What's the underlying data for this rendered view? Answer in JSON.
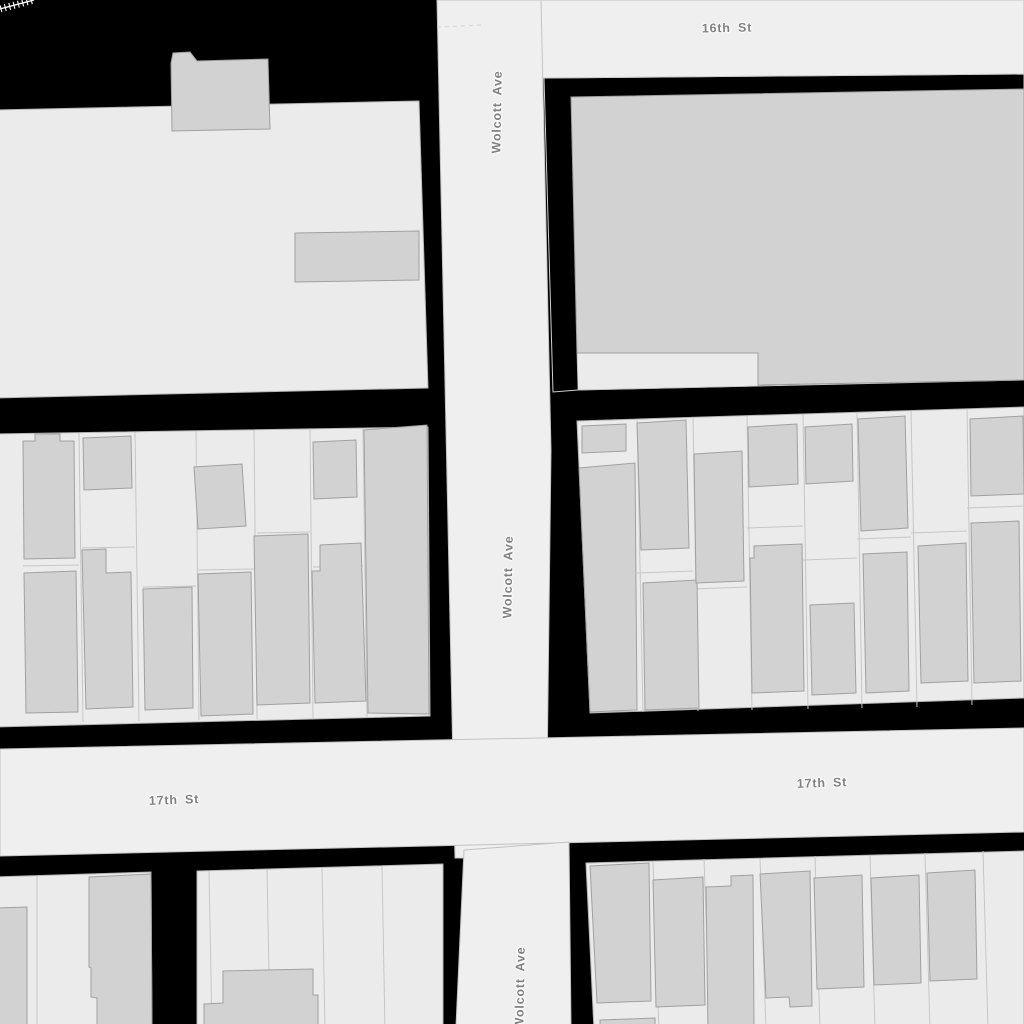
{
  "map": {
    "background": "#000000",
    "colors": {
      "street_fill": "#efefef",
      "block_fill": "#ebebeb",
      "building_fill": "#d2d2d2",
      "building_stroke": "#a0a0a0",
      "label_color": "#818181",
      "railroad": "#ffffff"
    },
    "labels": [
      {
        "text": "16th St",
        "x": 727,
        "y": 28,
        "rotate": -1
      },
      {
        "text": "Wolcott Ave",
        "x": 497,
        "y": 112,
        "rotate": -89
      },
      {
        "text": "Wolcott Ave",
        "x": 508,
        "y": 577,
        "rotate": -89
      },
      {
        "text": "17th St",
        "x": 174,
        "y": 800,
        "rotate": -2
      },
      {
        "text": "17th St",
        "x": 822,
        "y": 783,
        "rotate": -2
      },
      {
        "text": "Wolcott Ave",
        "x": 520,
        "y": 988,
        "rotate": -89
      }
    ],
    "streets": [
      {
        "name": "16th-st-band",
        "points": [
          [
            437,
            0
          ],
          [
            1024,
            0
          ],
          [
            1024,
            74
          ],
          [
            544,
            78
          ],
          [
            452,
            84
          ]
        ]
      },
      {
        "name": "wolcott-ave-upper",
        "points": [
          [
            437,
            0
          ],
          [
            541,
            0
          ],
          [
            551,
            450
          ],
          [
            546,
            858
          ],
          [
            455,
            858
          ],
          [
            446,
            430
          ]
        ]
      },
      {
        "name": "17th-st-band",
        "points": [
          [
            0,
            749
          ],
          [
            1024,
            728
          ],
          [
            1024,
            832
          ],
          [
            0,
            856
          ]
        ]
      },
      {
        "name": "wolcott-ave-lower",
        "points": [
          [
            464,
            850
          ],
          [
            569,
            842
          ],
          [
            571,
            1026
          ],
          [
            456,
            1026
          ]
        ]
      }
    ],
    "blocks": [
      {
        "name": "block-top-left",
        "style": "block",
        "points": [
          [
            -6,
            110
          ],
          [
            419,
            101
          ],
          [
            428,
            388
          ],
          [
            -6,
            398
          ]
        ]
      },
      {
        "name": "block-mid-left",
        "style": "block",
        "points": [
          [
            -6,
            434
          ],
          [
            428,
            427
          ],
          [
            430,
            716
          ],
          [
            -6,
            727
          ]
        ]
      },
      {
        "name": "block-top-right",
        "style": "block-outline",
        "points": [
          [
            544,
            78
          ],
          [
            1024,
            74
          ],
          [
            1024,
            380
          ],
          [
            578,
            390
          ],
          [
            553,
            392
          ]
        ]
      },
      {
        "name": "block-top-right-parcel-notch",
        "style": "block-notch",
        "points": [
          [
            577,
            352
          ],
          [
            758,
            351
          ],
          [
            758,
            386
          ],
          [
            578,
            390
          ]
        ]
      },
      {
        "name": "block-mid-right",
        "style": "block",
        "points": [
          [
            577,
            421
          ],
          [
            1024,
            407
          ],
          [
            1024,
            698
          ],
          [
            590,
            713
          ]
        ]
      },
      {
        "name": "block-bottom-left-a",
        "style": "block",
        "points": [
          [
            -6,
            877
          ],
          [
            151,
            872
          ],
          [
            152,
            1030
          ],
          [
            -6,
            1030
          ]
        ]
      },
      {
        "name": "block-bottom-left-b",
        "style": "block",
        "points": [
          [
            197,
            871
          ],
          [
            443,
            864
          ],
          [
            443,
            1030
          ],
          [
            197,
            1030
          ]
        ]
      },
      {
        "name": "block-bottom-right",
        "style": "block",
        "points": [
          [
            586,
            863
          ],
          [
            1024,
            851
          ],
          [
            1024,
            1030
          ],
          [
            594,
            1030
          ]
        ]
      }
    ],
    "parcel_lines": [
      [
        79,
        433,
        83,
        722
      ],
      [
        135,
        432,
        139,
        721
      ],
      [
        196,
        431,
        199,
        720
      ],
      [
        254,
        430,
        257,
        719
      ],
      [
        310,
        430,
        313,
        718
      ],
      [
        363,
        429,
        367,
        717
      ],
      [
        23,
        566,
        79,
        565
      ],
      [
        82,
        548,
        135,
        547
      ],
      [
        143,
        587,
        196,
        586
      ],
      [
        198,
        570,
        254,
        569
      ],
      [
        257,
        533,
        310,
        532
      ],
      [
        313,
        567,
        363,
        566
      ],
      [
        637,
        419,
        643,
        712
      ],
      [
        693,
        417,
        698,
        711
      ],
      [
        747,
        416,
        752,
        710
      ],
      [
        803,
        414,
        808,
        709
      ],
      [
        857,
        412,
        862,
        708
      ],
      [
        911,
        411,
        917,
        707
      ],
      [
        967,
        409,
        972,
        705
      ],
      [
        637,
        573,
        693,
        571
      ],
      [
        693,
        589,
        747,
        587
      ],
      [
        747,
        528,
        803,
        526
      ],
      [
        803,
        560,
        857,
        558
      ],
      [
        857,
        539,
        911,
        537
      ],
      [
        911,
        533,
        967,
        531
      ],
      [
        967,
        508,
        1024,
        506
      ],
      [
        37,
        876,
        37,
        1030
      ],
      [
        209,
        871,
        212,
        1030
      ],
      [
        267,
        869,
        270,
        1030
      ],
      [
        322,
        868,
        325,
        1030
      ],
      [
        382,
        866,
        385,
        1030
      ],
      [
        653,
        861,
        659,
        1030
      ],
      [
        704,
        859,
        710,
        1030
      ],
      [
        760,
        858,
        766,
        1030
      ],
      [
        815,
        856,
        820,
        1030
      ],
      [
        870,
        855,
        875,
        1030
      ],
      [
        925,
        853,
        930,
        1030
      ],
      [
        983,
        851,
        988,
        1030
      ]
    ],
    "buildings": [
      [
        [
          171,
          63
        ],
        [
          173,
          53
        ],
        [
          190,
          52
        ],
        [
          197,
          61
        ],
        [
          268,
          59
        ],
        [
          270,
          129
        ],
        [
          172,
          131
        ]
      ],
      [
        [
          295,
          233
        ],
        [
          419,
          231
        ],
        [
          419,
          280
        ],
        [
          295,
          282
        ]
      ],
      [
        [
          571,
          97
        ],
        [
          1024,
          89
        ],
        [
          1024,
          380
        ],
        [
          758,
          385
        ],
        [
          758,
          353
        ],
        [
          577,
          353
        ]
      ],
      [
        [
          23,
          441
        ],
        [
          35,
          441
        ],
        [
          35,
          434
        ],
        [
          60,
          434
        ],
        [
          60,
          441
        ],
        [
          74,
          441
        ],
        [
          75,
          558
        ],
        [
          24,
          559
        ]
      ],
      [
        [
          24,
          573
        ],
        [
          76,
          571
        ],
        [
          78,
          712
        ],
        [
          26,
          713
        ]
      ],
      [
        [
          83,
          438
        ],
        [
          131,
          436
        ],
        [
          132,
          488
        ],
        [
          84,
          490
        ]
      ],
      [
        [
          82,
          550
        ],
        [
          106,
          549
        ],
        [
          106,
          573
        ],
        [
          131,
          572
        ],
        [
          133,
          707
        ],
        [
          86,
          709
        ]
      ],
      [
        [
          143,
          589
        ],
        [
          192,
          587
        ],
        [
          193,
          708
        ],
        [
          145,
          710
        ]
      ],
      [
        [
          194,
          467
        ],
        [
          242,
          464
        ],
        [
          246,
          526
        ],
        [
          198,
          529
        ]
      ],
      [
        [
          198,
          574
        ],
        [
          251,
          572
        ],
        [
          253,
          714
        ],
        [
          201,
          716
        ]
      ],
      [
        [
          254,
          536
        ],
        [
          308,
          534
        ],
        [
          310,
          703
        ],
        [
          257,
          705
        ]
      ],
      [
        [
          313,
          442
        ],
        [
          356,
          440
        ],
        [
          357,
          497
        ],
        [
          314,
          499
        ]
      ],
      [
        [
          312,
          571
        ],
        [
          320,
          571
        ],
        [
          320,
          545
        ],
        [
          361,
          543
        ],
        [
          366,
          701
        ],
        [
          315,
          703
        ]
      ],
      [
        [
          364,
          430
        ],
        [
          427,
          425
        ],
        [
          429,
          714
        ],
        [
          368,
          713
        ]
      ],
      [
        [
          582,
          426
        ],
        [
          626,
          424
        ],
        [
          626,
          451
        ],
        [
          582,
          453
        ]
      ],
      [
        [
          579,
          468
        ],
        [
          635,
          463
        ],
        [
          637,
          710
        ],
        [
          590,
          712
        ]
      ],
      [
        [
          637,
          423
        ],
        [
          686,
          420
        ],
        [
          689,
          548
        ],
        [
          641,
          550
        ]
      ],
      [
        [
          643,
          583
        ],
        [
          697,
          580
        ],
        [
          699,
          708
        ],
        [
          645,
          710
        ]
      ],
      [
        [
          694,
          454
        ],
        [
          742,
          451
        ],
        [
          744,
          581
        ],
        [
          696,
          583
        ]
      ],
      [
        [
          748,
          427
        ],
        [
          797,
          424
        ],
        [
          798,
          484
        ],
        [
          749,
          487
        ]
      ],
      [
        [
          750,
          558
        ],
        [
          754,
          558
        ],
        [
          754,
          546
        ],
        [
          802,
          544
        ],
        [
          804,
          691
        ],
        [
          752,
          693
        ]
      ],
      [
        [
          805,
          427
        ],
        [
          852,
          424
        ],
        [
          853,
          481
        ],
        [
          806,
          484
        ]
      ],
      [
        [
          810,
          605
        ],
        [
          854,
          603
        ],
        [
          856,
          693
        ],
        [
          812,
          695
        ]
      ],
      [
        [
          858,
          419
        ],
        [
          905,
          416
        ],
        [
          908,
          528
        ],
        [
          861,
          531
        ]
      ],
      [
        [
          863,
          554
        ],
        [
          907,
          552
        ],
        [
          909,
          691
        ],
        [
          866,
          693
        ]
      ],
      [
        [
          918,
          546
        ],
        [
          966,
          543
        ],
        [
          968,
          681
        ],
        [
          921,
          683
        ]
      ],
      [
        [
          970,
          419
        ],
        [
          1023,
          416
        ],
        [
          1024,
          494
        ],
        [
          971,
          496
        ]
      ],
      [
        [
          971,
          523
        ],
        [
          1019,
          521
        ],
        [
          1021,
          681
        ],
        [
          974,
          683
        ]
      ],
      [
        [
          -6,
          908
        ],
        [
          27,
          907
        ],
        [
          27,
          1030
        ],
        [
          -6,
          1030
        ]
      ],
      [
        [
          89,
          877
        ],
        [
          151,
          874
        ],
        [
          152,
          1030
        ],
        [
          97,
          1030
        ],
        [
          97,
          998
        ],
        [
          91,
          997
        ],
        [
          91,
          968
        ],
        [
          89,
          967
        ]
      ],
      [
        [
          204,
          1004
        ],
        [
          223,
          1003
        ],
        [
          223,
          971
        ],
        [
          313,
          969
        ],
        [
          313,
          995
        ],
        [
          318,
          995
        ],
        [
          318,
          1030
        ],
        [
          204,
          1030
        ]
      ],
      [
        [
          590,
          866
        ],
        [
          649,
          863
        ],
        [
          651,
          1001
        ],
        [
          597,
          1003
        ]
      ],
      [
        [
          653,
          880
        ],
        [
          703,
          877
        ],
        [
          705,
          1005
        ],
        [
          656,
          1007
        ]
      ],
      [
        [
          706,
          887
        ],
        [
          731,
          886
        ],
        [
          731,
          876
        ],
        [
          753,
          875
        ],
        [
          754,
          1030
        ],
        [
          708,
          1030
        ]
      ],
      [
        [
          760,
          874
        ],
        [
          810,
          871
        ],
        [
          812,
          1006
        ],
        [
          790,
          1007
        ],
        [
          789,
          997
        ],
        [
          766,
          998
        ]
      ],
      [
        [
          814,
          878
        ],
        [
          862,
          875
        ],
        [
          864,
          987
        ],
        [
          817,
          989
        ]
      ],
      [
        [
          871,
          878
        ],
        [
          919,
          875
        ],
        [
          921,
          983
        ],
        [
          874,
          985
        ]
      ],
      [
        [
          927,
          873
        ],
        [
          975,
          870
        ],
        [
          977,
          979
        ],
        [
          930,
          981
        ]
      ],
      [
        [
          600,
          1020
        ],
        [
          655,
          1018
        ],
        [
          655,
          1030
        ],
        [
          600,
          1030
        ]
      ]
    ],
    "railroad": {
      "x1": 0,
      "y1": 9,
      "x2": 34,
      "y2": 0,
      "tick_spacing": 4.5,
      "tick_len": 7
    },
    "crosswalk": {
      "x1": 437,
      "y1": 27,
      "x2": 481,
      "y2": 25
    }
  }
}
